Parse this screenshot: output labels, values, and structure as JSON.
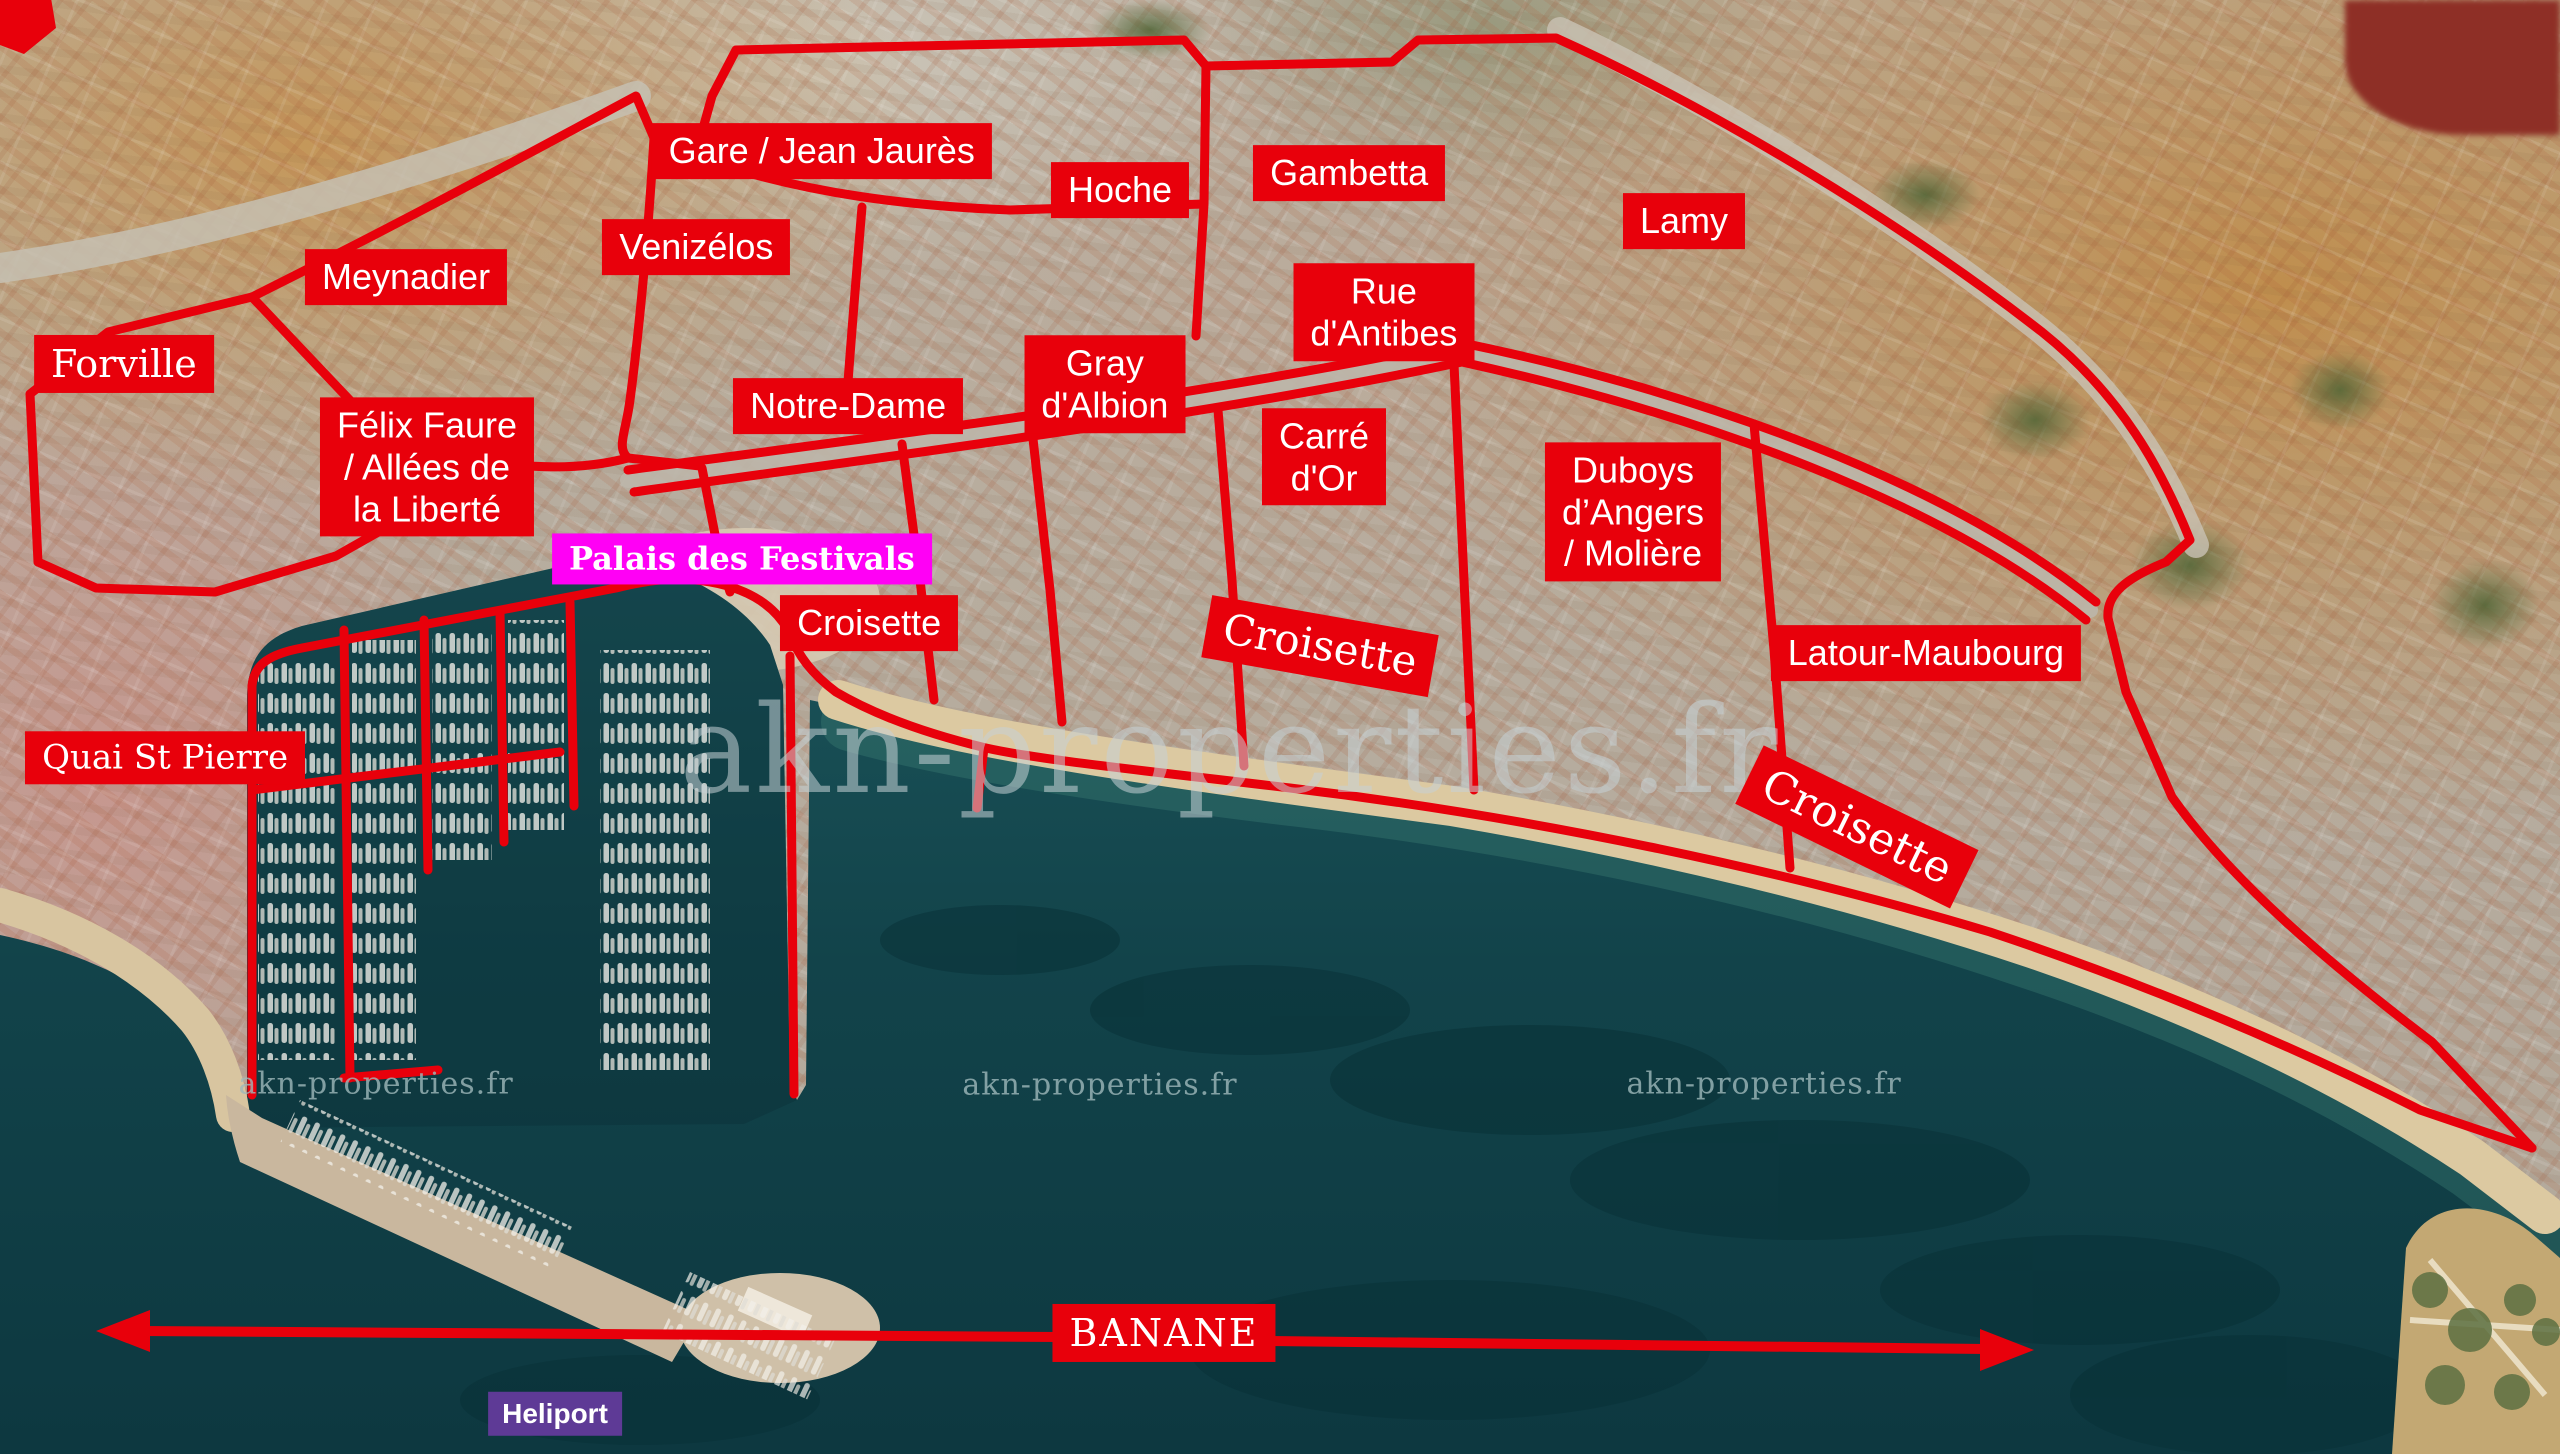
{
  "colors": {
    "district_red": "#e8000b",
    "magenta": "#ff00f5",
    "heliport_purple": "#5e3a96",
    "sea_teal": "#12434a",
    "sand": "#dcc9a1"
  },
  "labels": {
    "districts": [
      {
        "id": "forville",
        "label": "Forville"
      },
      {
        "id": "meynadier",
        "label": "Meynadier"
      },
      {
        "id": "gare-jean-jaures",
        "label": "Gare / Jean Jaurès"
      },
      {
        "id": "venizelos",
        "label": "Venizélos"
      },
      {
        "id": "hoche",
        "label": "Hoche"
      },
      {
        "id": "gambetta",
        "label": "Gambetta"
      },
      {
        "id": "lamy",
        "label": "Lamy"
      },
      {
        "id": "rue-dantibes",
        "label": "Rue\nd'Antibes"
      },
      {
        "id": "notre-dame",
        "label": "Notre-Dame"
      },
      {
        "id": "gray-dalbion",
        "label": "Gray\nd'Albion"
      },
      {
        "id": "carre-dor",
        "label": "Carré\nd'Or"
      },
      {
        "id": "duboys-moliere",
        "label": "Duboys\nd’Angers\n/ Molière"
      },
      {
        "id": "felix-faure",
        "label": "Félix Faure\n/ Allées de\nla Liberté"
      },
      {
        "id": "latour-maubourg",
        "label": "Latour-Maubourg"
      },
      {
        "id": "croisette-strip",
        "label": "Croisette"
      }
    ],
    "streets": [
      {
        "id": "croisette-mid",
        "label": "Croisette"
      },
      {
        "id": "croisette-east",
        "label": "Croisette"
      },
      {
        "id": "quai-st-pierre",
        "label": "Quai St Pierre"
      }
    ],
    "pois": [
      {
        "id": "palais-des-festivals",
        "label": "Palais des Festivals"
      },
      {
        "id": "heliport",
        "label": "Heliport"
      }
    ],
    "banane_label": "BANANE",
    "watermark_text": "akn-properties.fr"
  }
}
